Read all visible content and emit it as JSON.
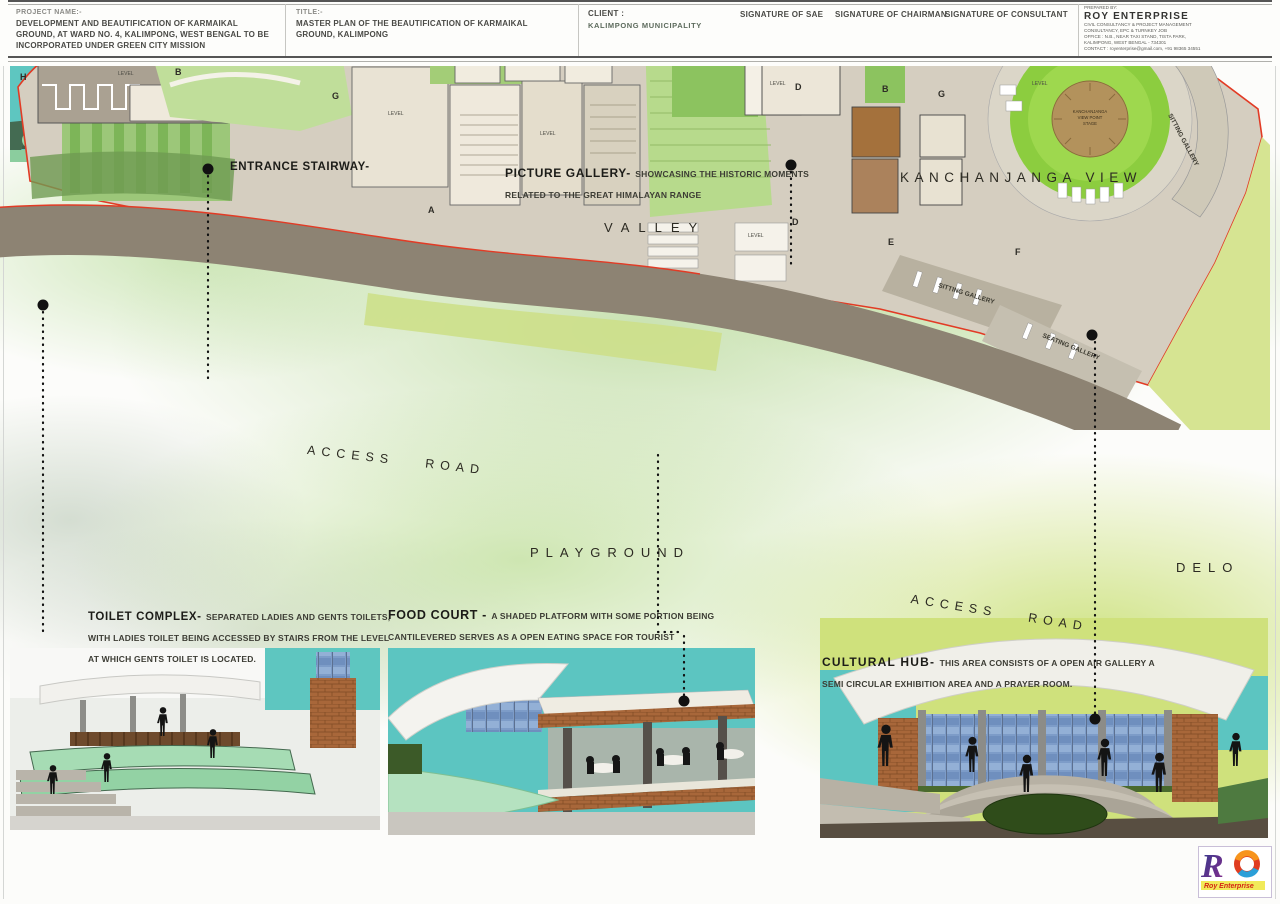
{
  "captions": {
    "entrance": {
      "title": "ENTRANCE STAIRWAY-"
    },
    "picture_gallery": {
      "title": "PICTURE GALLERY-",
      "desc": "SHOWCASING THE HISTORIC MOMENTS RELATED TO THE GREAT HIMALAYAN RANGE"
    },
    "toilet": {
      "title": "TOILET COMPLEX-",
      "desc": "SEPARATED LADIES AND GENTS TOILETS, WITH LADIES TOILET BEING ACCESSED BY STAIRS FROM THE LEVEL AT WHICH GENTS TOILET IS LOCATED."
    },
    "food_court": {
      "title": "FOOD COURT -",
      "desc": "A SHADED PLATFORM WITH SOME PORTION BEING CANTILEVERED SERVES AS A OPEN EATING SPACE FOR TOURIST"
    },
    "cultural_hub": {
      "title": "CULTURAL HUB-",
      "desc": "THIS AREA CONSISTS OF A OPEN AIR GALLERY A SEMI CIRCULAR EXHIBITION AREA AND A PRAYER ROOM."
    }
  },
  "plan": {
    "valley": "VALLEY",
    "kanchanjanga_view": "KANCHANJANGA VIEW",
    "access_road": "ACCESS ROAD",
    "playground": "PLAYGROUND",
    "delo": "DELO",
    "sitting_gallery": "SITTING GALLERY",
    "seating_gallery": "SEATING GALLERY",
    "level": "LEVEL",
    "viewpoint": {
      "l1": "KANCHANJANGA",
      "l2": "VIEW POINT",
      "l3": "STAGE"
    },
    "sections": {
      "a": "A",
      "b": "B",
      "c": "C",
      "d": "D",
      "e": "E",
      "f": "F",
      "g": "G",
      "h": "H"
    }
  },
  "title_block": {
    "project_label": "PROJECT NAME:-",
    "project_name": "DEVELOPMENT AND BEAUTIFICATION OF KARMAIKAL GROUND, AT WARD NO. 4, KALIMPONG, WEST BENGAL TO BE INCORPORATED UNDER GREEN CITY MISSION",
    "title_label": "TITLE:-",
    "title": "MASTER PLAN OF THE BEAUTIFICATION OF KARMAIKAL GROUND, KALIMPONG",
    "client_label": "CLIENT :",
    "client": "KALIMPONG MUNICIPALITY",
    "sig_sae": "SIGNATURE OF SAE",
    "sig_chairman": "SIGNATURE OF CHAIRMAN",
    "sig_consultant": "SIGNATURE OF CONSULTANT",
    "prepared_label": "PREPARED BY:",
    "firm": "ROY ENTERPRISE",
    "firm_lines": [
      "CIVIL CONSULTANCY & PROJECT MANAGEMENT",
      "CONSULTANCY, EPC & TURNKEY JOB",
      "OFFICE : N.B., NEAR TAXI STAND, TISTA PARK,",
      "KALIMPONG, WEST BENGAL - 734301",
      "CONTACT : royenterprise@gmail.com, +91 98365 34551"
    ],
    "logo_caption": "Roy Enterprise"
  },
  "colors": {
    "sky_teal": "#5cc5c1",
    "mint": "#a6dcb4",
    "brick": "#a8673a",
    "road": "#8d8373",
    "boundary_red": "#e23b25",
    "wash_green": "#bcdb8a"
  }
}
